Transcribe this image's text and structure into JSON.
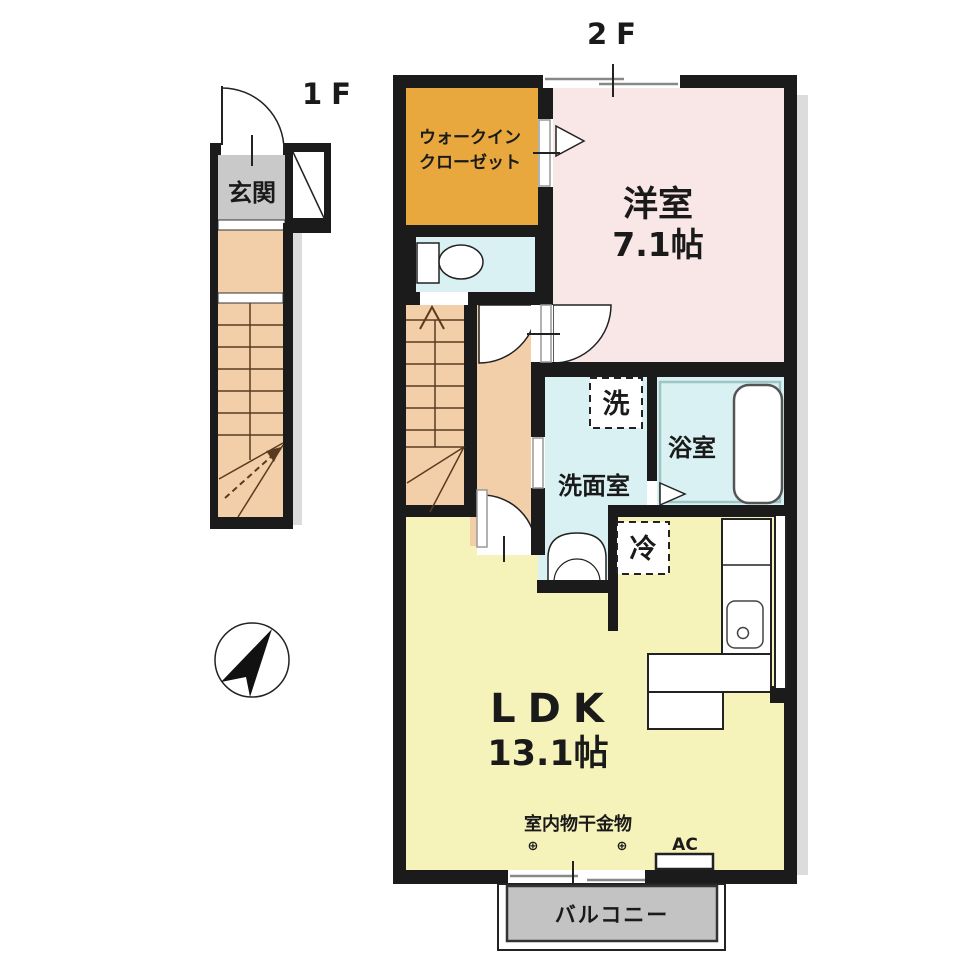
{
  "plan": {
    "floor1_label": "1F",
    "floor2_label": "2F"
  },
  "rooms": {
    "entrance": {
      "name": "玄関"
    },
    "walk_in_closet": {
      "line1": "ウォークイン",
      "line2": "クローゼット"
    },
    "western_room": {
      "name": "洋室",
      "size": "7.1帖"
    },
    "washroom": {
      "name": "洗面室"
    },
    "bathroom": {
      "name": "浴室"
    },
    "ldk": {
      "name": "LDK",
      "size": "13.1帖"
    },
    "balcony": {
      "name": "バルコニー"
    }
  },
  "fixtures": {
    "washer_symbol": "洗",
    "refrigerator_symbol": "冷",
    "air_conditioner": "AC",
    "laundry_hardware": "室内物干金物",
    "laundry_hook_symbol": "⊕"
  },
  "colors": {
    "wall": "#1b1b1b",
    "western_room": "#f9e7e7",
    "closet": "#e8a83d",
    "wet_area": "#d9f1f2",
    "ldk": "#f6f3ba",
    "hall_stairs": "#f3cfa9",
    "entrance": "#c9c9c9",
    "balcony": "#c3c3c3",
    "shadow": "#dcdcdc"
  }
}
